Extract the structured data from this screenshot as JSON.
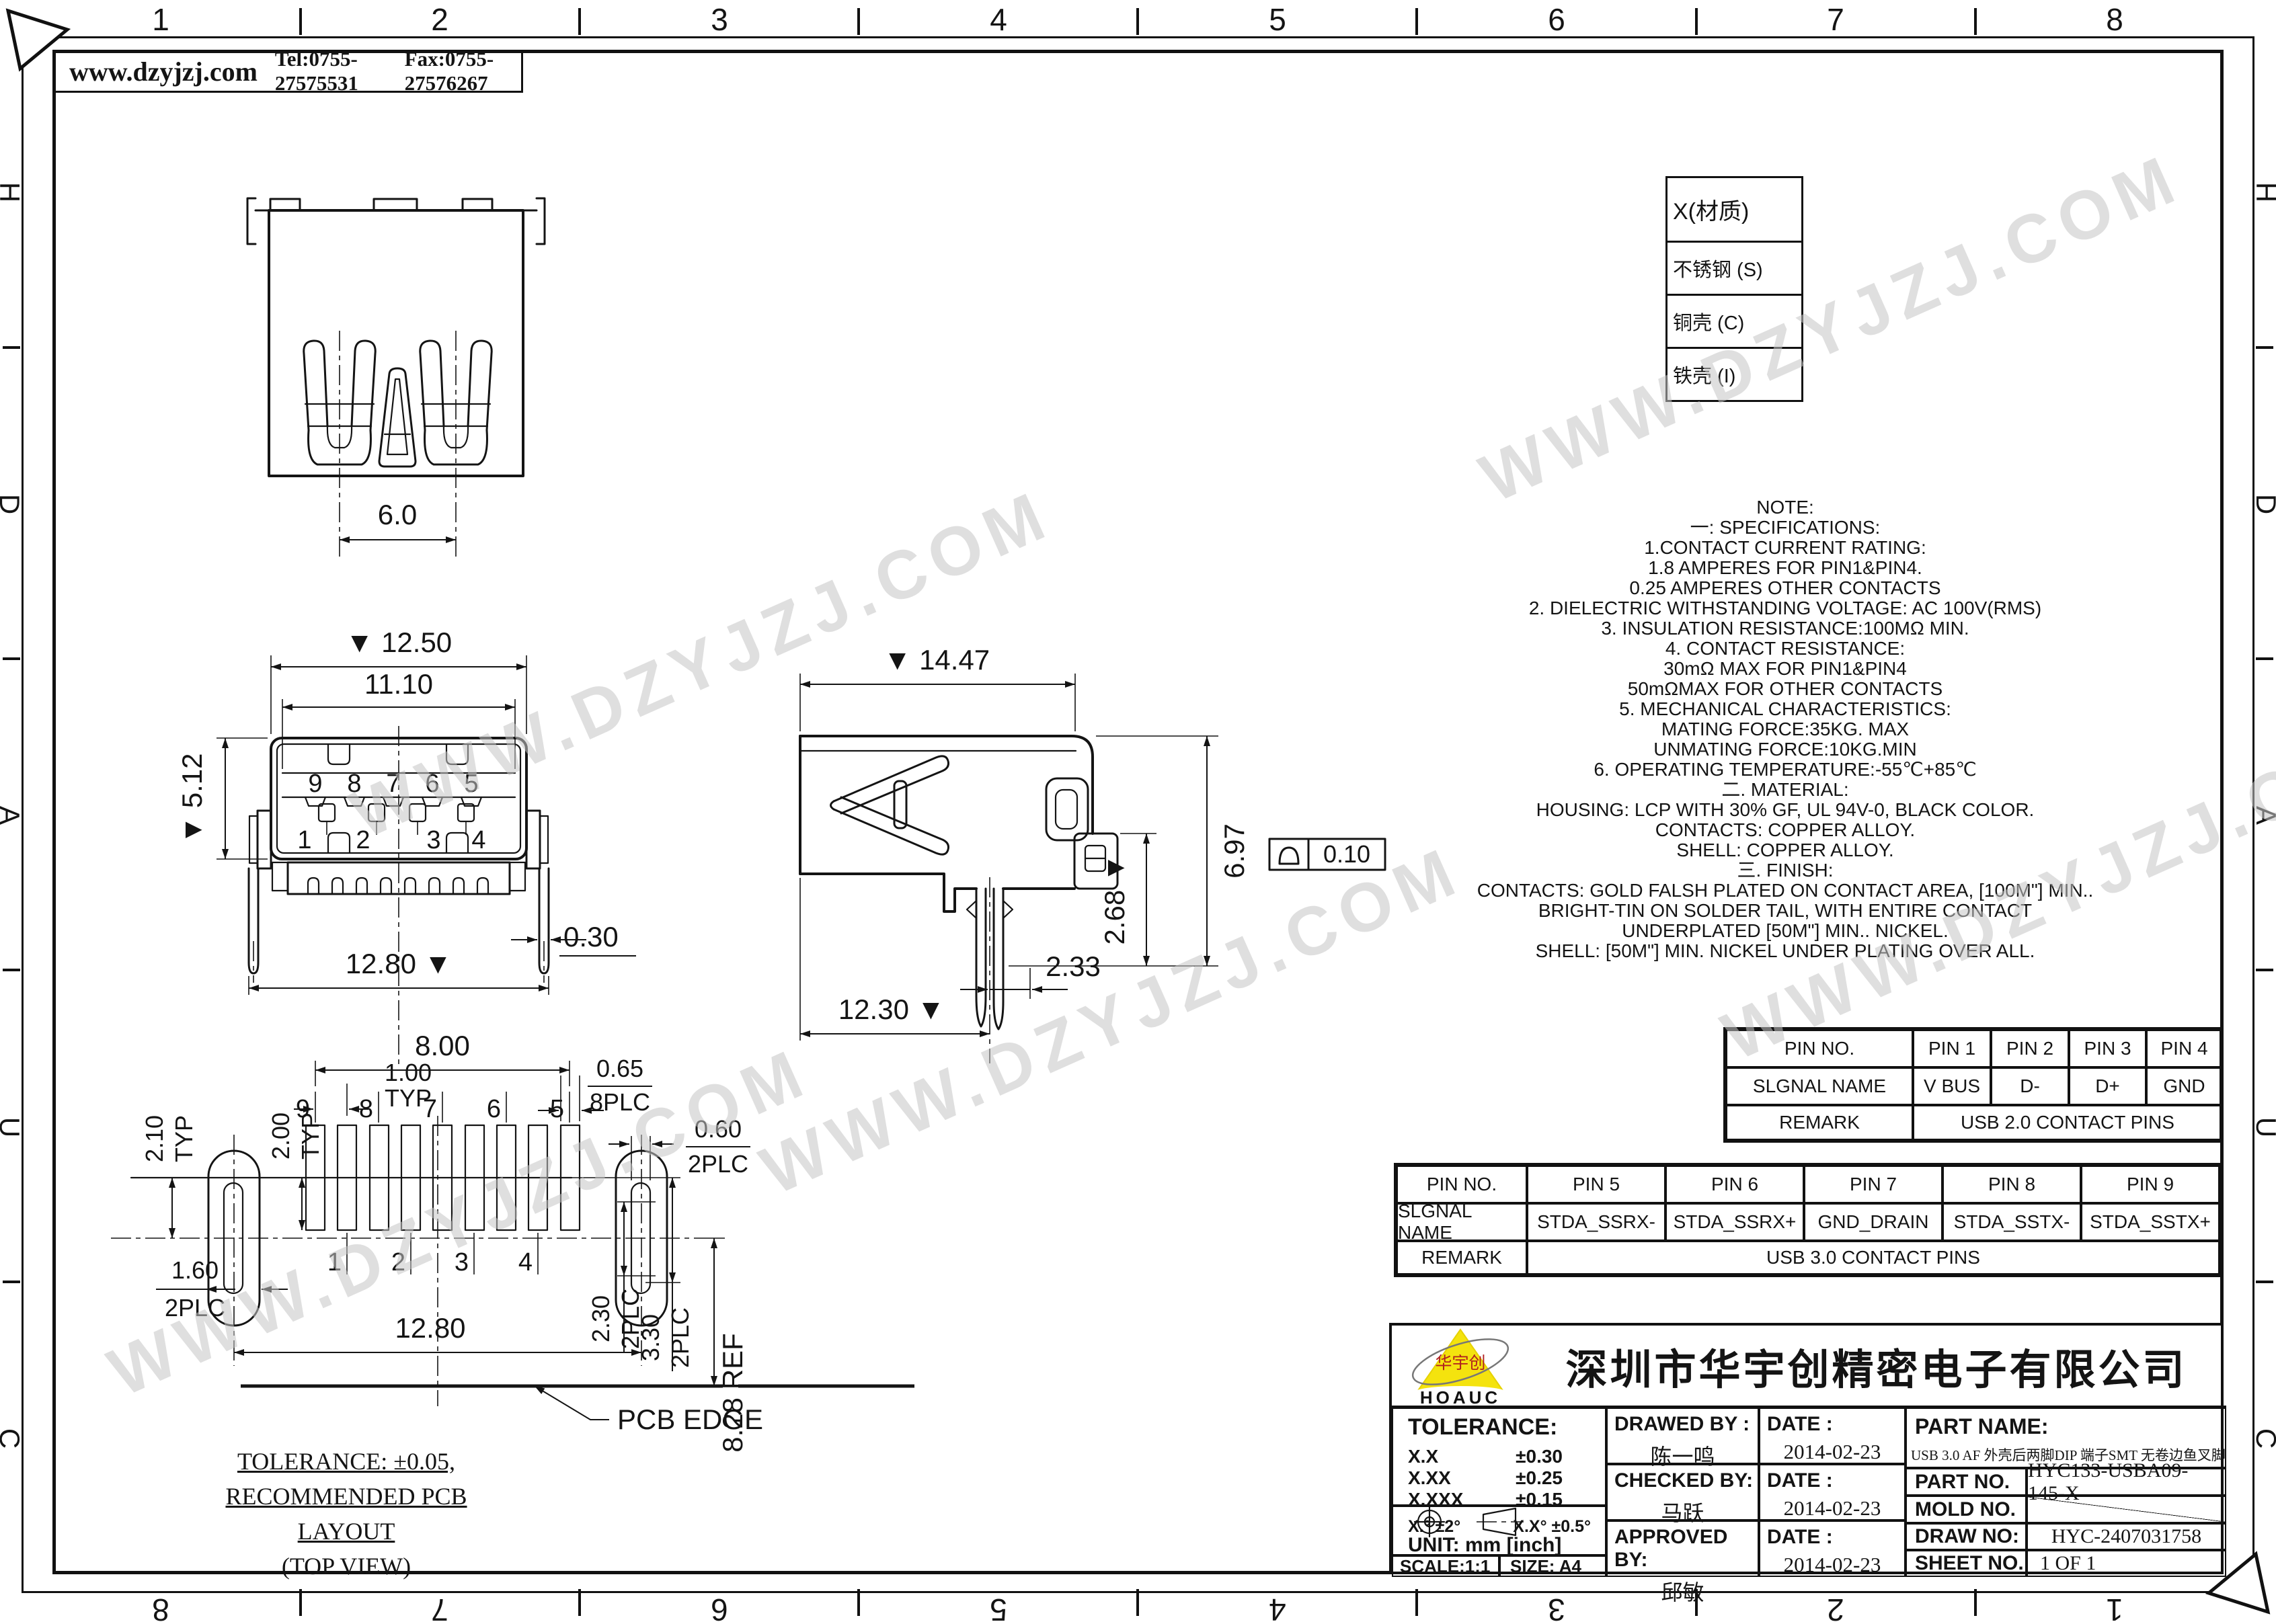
{
  "border": {
    "top_numbers": [
      "1",
      "2",
      "3",
      "4",
      "5",
      "6",
      "7",
      "8"
    ],
    "bottom_numbers": [
      "8",
      "7",
      "6",
      "5",
      "4",
      "3",
      "2",
      "1"
    ],
    "left_letters": [
      "H",
      "D",
      "A",
      "U",
      "C"
    ],
    "right_letters": [
      "H",
      "D",
      "A",
      "U",
      "C"
    ]
  },
  "header": {
    "website": "www.dzyjzj.com",
    "tel": "Tel:0755-27575531",
    "fax": "Fax:0755-27576267"
  },
  "watermark": {
    "text": "WWW.DZYJZJ.COM",
    "color": "#c6c6c6"
  },
  "material_table": {
    "header": "X(材质)",
    "rows": [
      "不锈钢 (S)",
      "铜壳 (C)",
      "铁壳 (I)"
    ]
  },
  "notes": {
    "lines": [
      "NOTE:",
      "一: SPECIFICATIONS:",
      "1.CONTACT CURRENT RATING:",
      "1.8 AMPERES FOR PIN1&PIN4.",
      "0.25 AMPERES OTHER CONTACTS",
      "2. DIELECTRIC WITHSTANDING VOLTAGE: AC 100V(RMS)",
      "3. INSULATION RESISTANCE:100MΩ MIN.",
      "4. CONTACT RESISTANCE:",
      "30mΩ MAX FOR PIN1&PIN4",
      "50mΩMAX FOR OTHER CONTACTS",
      "5. MECHANICAL CHARACTERISTICS:",
      "MATING FORCE:35KG. MAX",
      "UNMATING FORCE:10KG.MIN",
      "6. OPERATING TEMPERATURE:-55℃+85℃",
      "二. MATERIAL:",
      "HOUSING: LCP WITH 30% GF, UL 94V-0, BLACK COLOR.",
      "CONTACTS: COPPER ALLOY.",
      "SHELL: COPPER ALLOY.",
      "三. FINISH:",
      "CONTACTS:  GOLD FALSH PLATED ON CONTACT AREA,  [100M\"] MIN..",
      "BRIGHT-TIN ON SOLDER TAIL, WITH ENTIRE CONTACT",
      "UNDERPLATED  [50M\"] MIN.. NICKEL.",
      "SHELL: [50M\"] MIN. NICKEL UNDER PLATING OVER ALL."
    ]
  },
  "pin_table_usb2": {
    "row1": [
      "PIN NO.",
      "PIN 1",
      "PIN 2",
      "PIN 3",
      "PIN 4"
    ],
    "row2": [
      "SLGNAL NAME",
      "V BUS",
      "D-",
      "D+",
      "GND"
    ],
    "remark_label": "REMARK",
    "remark_value": "USB 2.0 CONTACT PINS"
  },
  "pin_table_usb3": {
    "row1": [
      "PIN NO.",
      "PIN 5",
      "PIN 6",
      "PIN 7",
      "PIN 8",
      "PIN 9"
    ],
    "row2": [
      "SLGNAL NAME",
      "STDA_SSRX-",
      "STDA_SSRX+",
      "GND_DRAIN",
      "STDA_SSTX-",
      "STDA_SSTX+"
    ],
    "remark_label": "REMARK",
    "remark_value": "USB 3.0 CONTACT PINS"
  },
  "views": {
    "rear": {
      "dim_width": "6.0"
    },
    "front": {
      "dim_outer": "▼ 12.50",
      "dim_inner": "11.10",
      "dim_height": "▼ 5.12",
      "dim_leg": "0.30",
      "dim_span": "12.80 ▼",
      "pins_top": [
        "9",
        "8",
        "7",
        "6",
        "5"
      ],
      "pins_bottom": [
        "1",
        "2",
        "3",
        "4"
      ]
    },
    "side": {
      "dim_top": "▼ 14.47",
      "dim_height": "6.97",
      "dim_step": "2.68 ▼",
      "dim_profile": "0.10",
      "dim_fork": "2.33",
      "dim_bottom": "12.30 ▼"
    },
    "layout": {
      "dim_span": "8.00",
      "dim_pitch": "1.00",
      "dim_pitch_n": "TYP",
      "dim_pad": "0.65",
      "dim_pad_n": "8PLC",
      "dim_slot": "0.60",
      "dim_slot_n": "2PLC",
      "dim_row1": "2.10",
      "dim_row1_n": "TYP",
      "dim_row2": "2.00",
      "dim_row2_n": "TYP",
      "dim_oval": "1.60",
      "dim_oval_n": "2PLC",
      "dim_a": "2.30",
      "dim_a_n": "2PLC",
      "dim_b": "3.30",
      "dim_b_n": "2PLC",
      "dim_ref": "8.28 REF",
      "dim_total": "12.80",
      "pins_top": [
        "9",
        "8",
        "7",
        "6",
        "5"
      ],
      "pins_bottom": [
        "1",
        "2",
        "3",
        "4"
      ],
      "pcb_edge": "PCB EDGE",
      "note1": "TOLERANCE: ±0.05,",
      "note2": "RECOMMENDED PCB LAYOUT",
      "note3": "(TOP VIEW)"
    }
  },
  "title_block": {
    "company": "深圳市华宇创精密电子有限公司",
    "logo_text": "华宇创",
    "logo_sub": "HOAUC",
    "tolerance_title": "TOLERANCE:",
    "tol_rows": [
      [
        "X.X",
        "±0.30"
      ],
      [
        "X.XX",
        "±0.25"
      ],
      [
        "X.XXX",
        "±0.15"
      ]
    ],
    "tol_angle1": "X.°  ±2°",
    "tol_angle2": "X.X°  ±0.5°",
    "unit": "UNIT:  mm  [inch]",
    "scale": "SCALE:1:1",
    "size": "SIZE:  A4",
    "drawed_label": "DRAWED BY :",
    "drawed_value": "陈一鸣",
    "checked_label": "CHECKED BY:",
    "checked_value": "马跃",
    "approved_label": "APPROVED BY:",
    "approved_value": "邱敏",
    "date_label": "DATE :",
    "date1": "2014-02-23",
    "date2": "2014-02-23",
    "date3": "2014-02-23",
    "part_name_label": "PART NAME:",
    "part_name_value": "USB 3.0 AF 外壳后两脚DIP 端子SMT 无卷边鱼叉脚",
    "part_no_label": "PART NO.",
    "part_no_value": "HYC133-USBA09-145-X",
    "mold_label": "MOLD NO.",
    "draw_label": "DRAW NO:",
    "draw_value": "HYC-2407031758",
    "sheet_label": "SHEET NO.",
    "sheet_value": "1 OF 1"
  }
}
